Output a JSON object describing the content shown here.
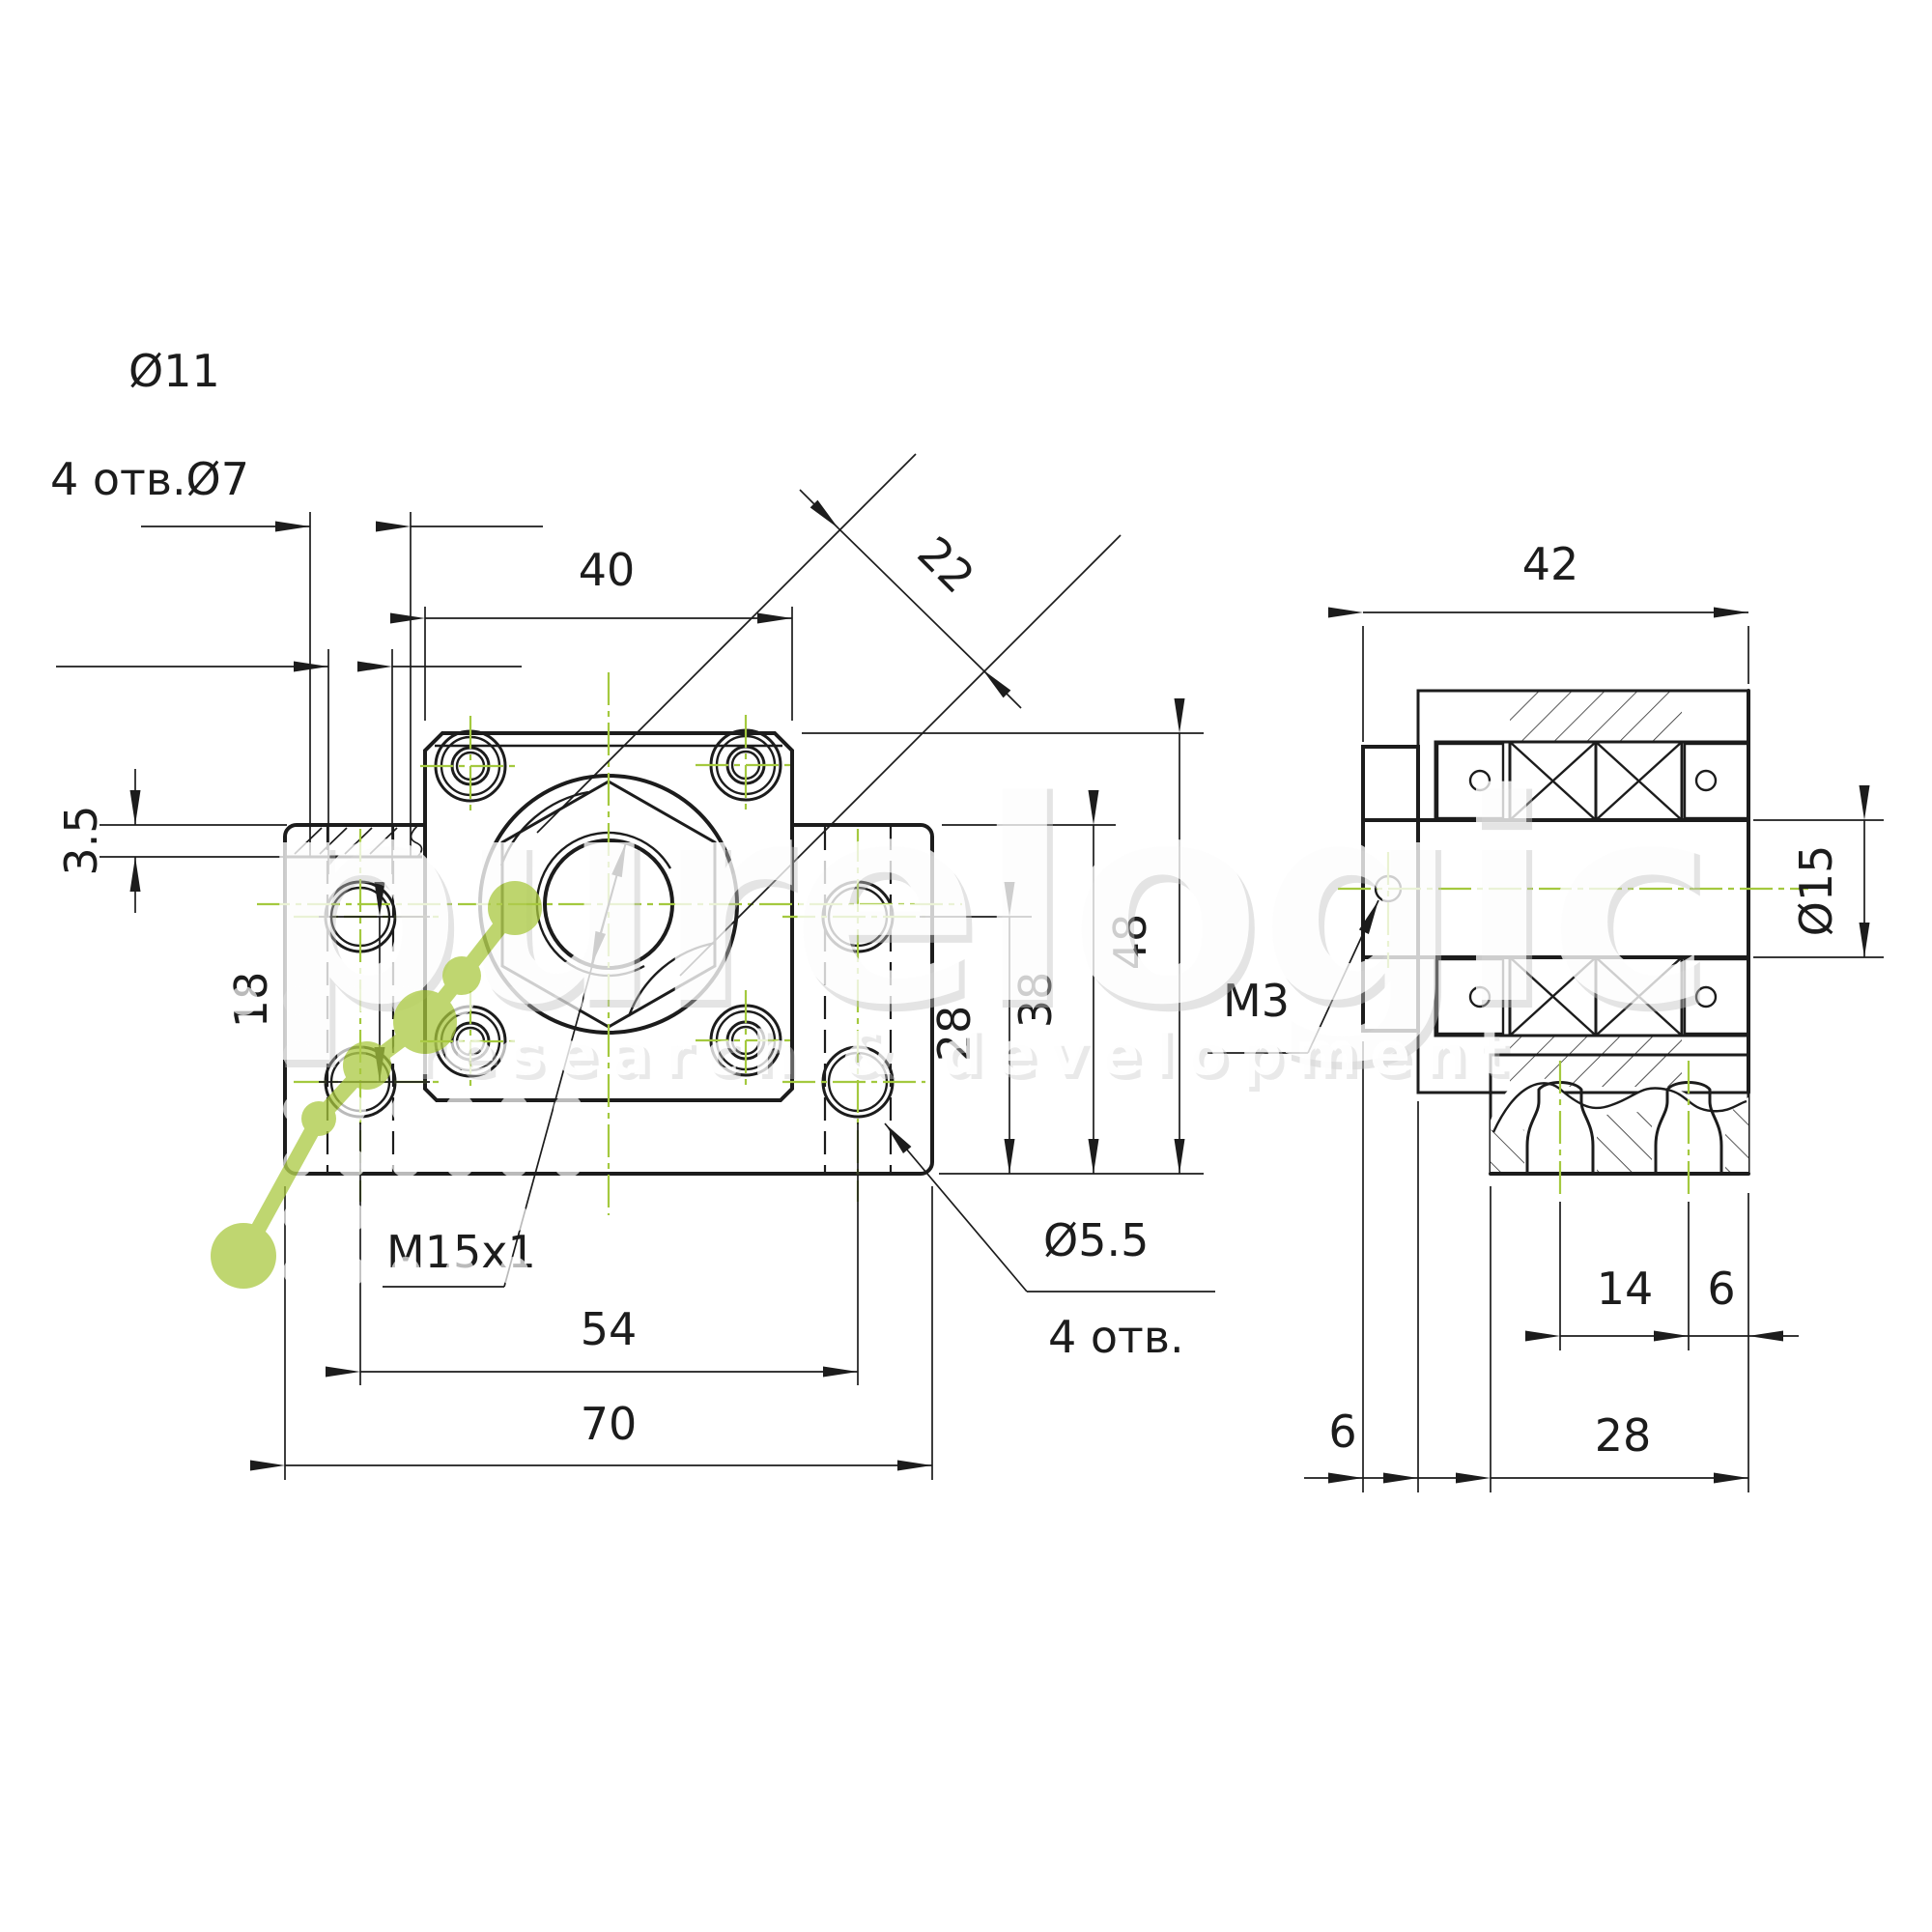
{
  "drawing": {
    "background": "#ffffff",
    "line_color": "#1c1c1c",
    "centerline_color": "#a4c93f",
    "views": {
      "front": {
        "dims": {
          "counterbore_dia": "Ø11",
          "mount_holes": "4 отв.Ø7",
          "flange_width": "40",
          "boss_dia": "22",
          "step_depth": "3.5",
          "hole_row_spacing": "18",
          "height_to_hole_axis": "28",
          "wing_height": "38",
          "total_height": "48",
          "thread": "M15x1",
          "hole_spacing": "54",
          "base_width": "70",
          "flange_hole_dia": "Ø5.5",
          "flange_hole_qty": "4 отв."
        }
      },
      "side": {
        "dims": {
          "depth": "42",
          "bore_dia": "Ø15",
          "set_screw": "M3",
          "slot_offset": "14",
          "slot_edge": "6",
          "collar_width": "6",
          "body_depth": "28"
        }
      }
    },
    "watermark": {
      "brand": "purelogic",
      "tagline": "research & development",
      "accent": "#a9c83d"
    }
  }
}
